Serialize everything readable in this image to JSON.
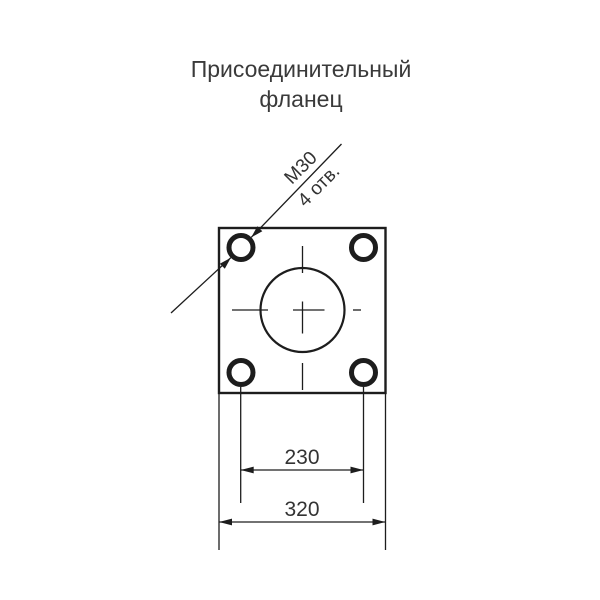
{
  "drawing": {
    "title_line1": "Присоединительный",
    "title_line2": "фланец",
    "leader_label": {
      "thread_size": "М30",
      "hole_count": "4 отв."
    },
    "dimensions": {
      "bolt_hole_spacing": "230",
      "flange_width": "320"
    },
    "colors": {
      "line": "#1d1d1d",
      "text": "#3a3a3a",
      "flange_fill_light": "#f5f5f5",
      "flange_fill_dark": "#c2c2c2",
      "background": "#ffffff"
    }
  }
}
